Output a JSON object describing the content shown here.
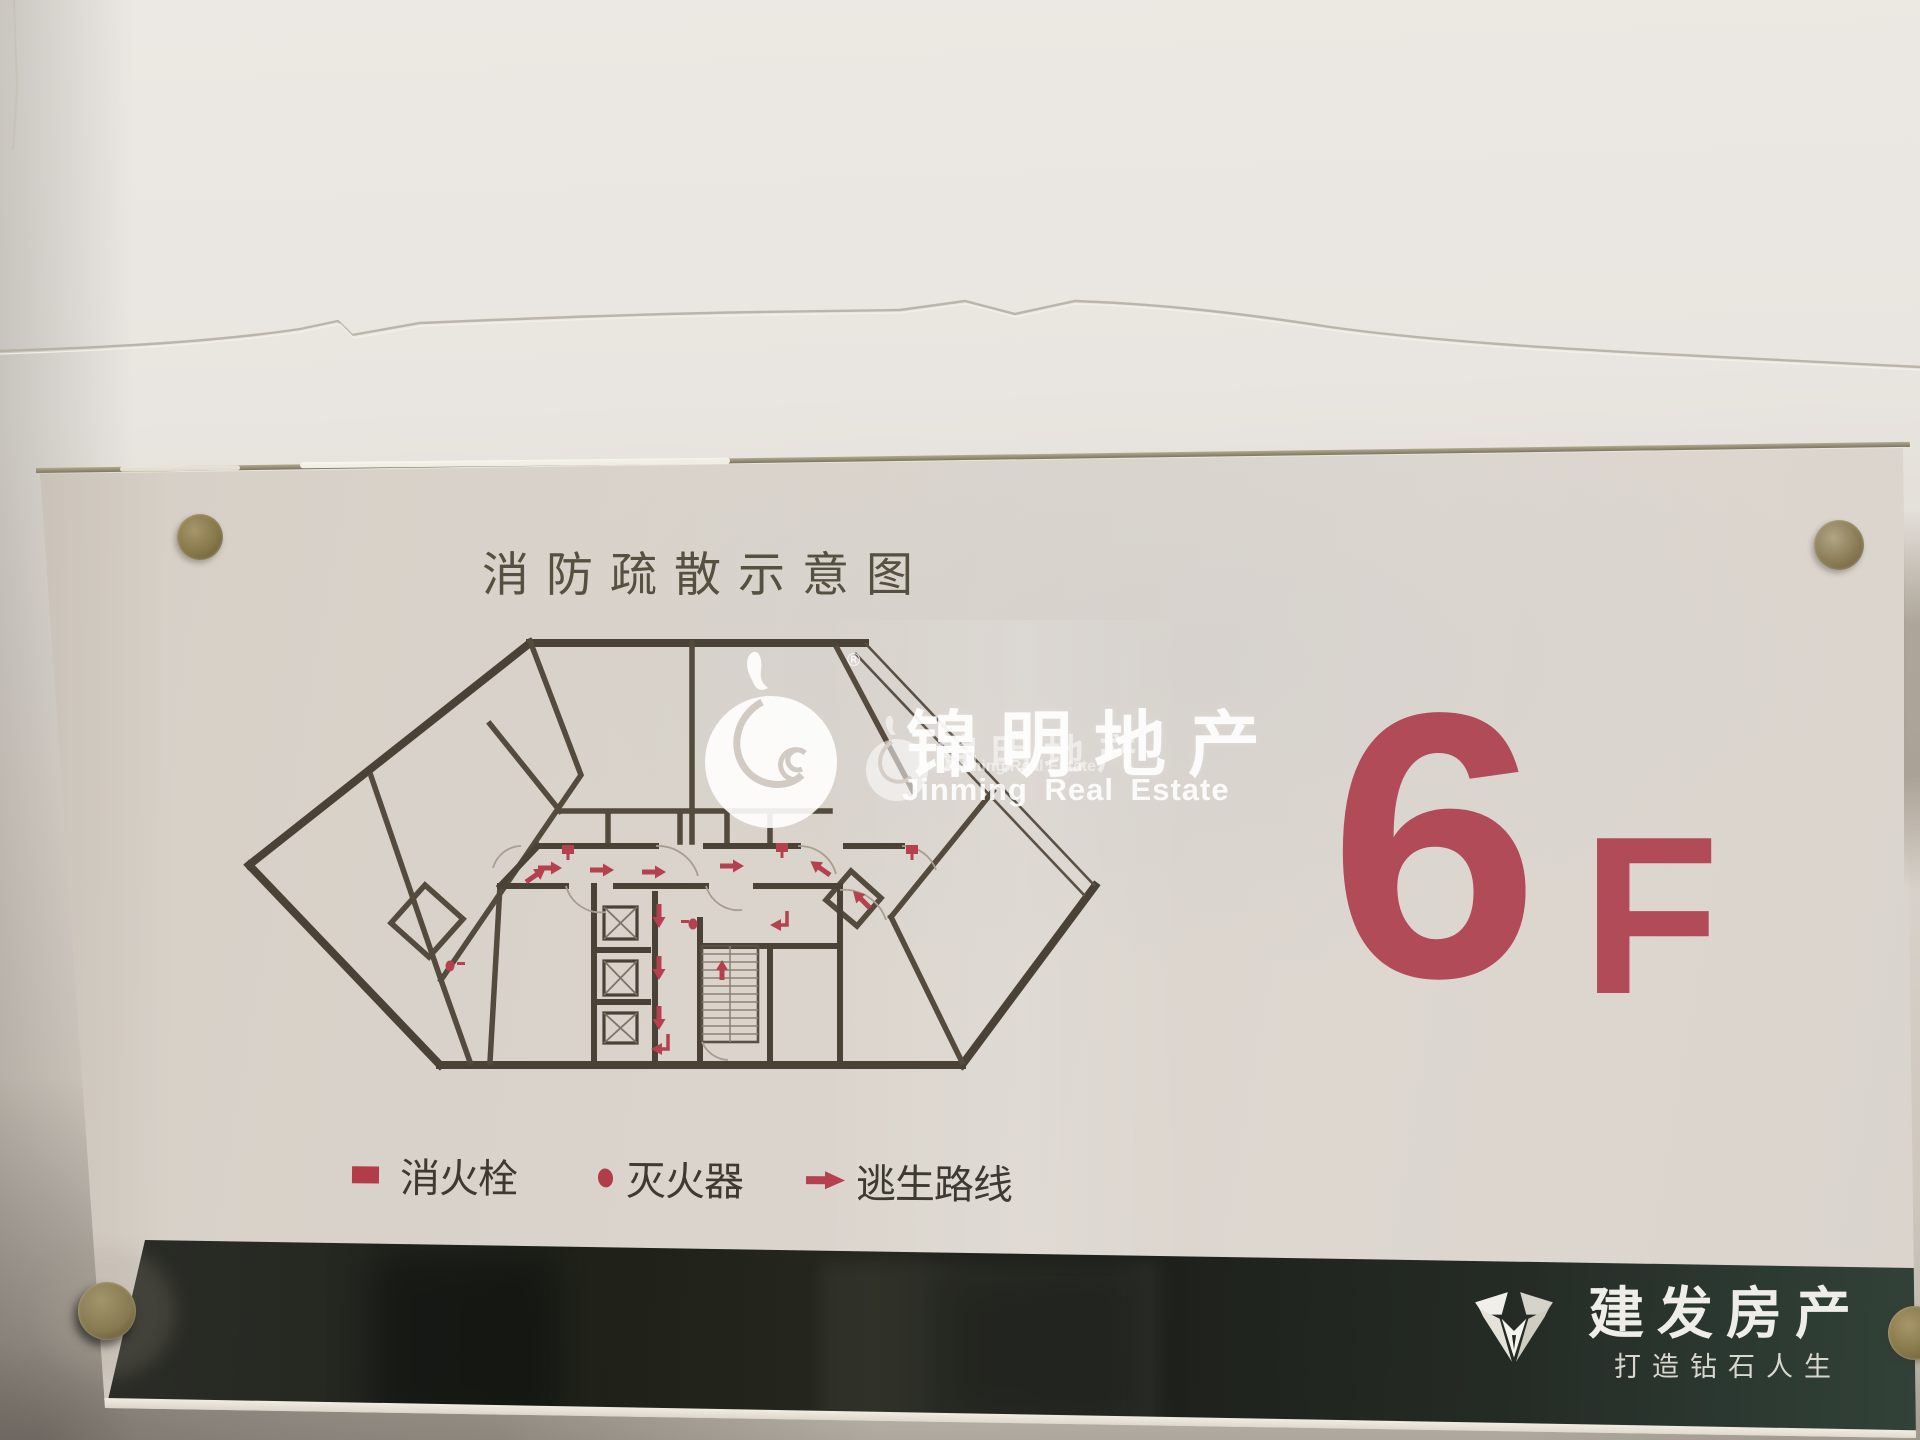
{
  "plate": {
    "title": "消防疏散示意图",
    "floor_label": {
      "number": "6",
      "suffix": "F"
    },
    "legend": {
      "items": [
        {
          "symbol": "hydrant-square",
          "label": "消火栓"
        },
        {
          "symbol": "extinguisher-dot",
          "label": "灭火器"
        },
        {
          "symbol": "route-arrow",
          "label": "逃生路线"
        }
      ]
    },
    "watermark": {
      "registered": "®",
      "cn": "锦明地产",
      "en": "Jinming Real Estate"
    },
    "brand": {
      "name": "建发房产",
      "slogan": "打造钻石人生"
    },
    "colors": {
      "legend_red": "#b23c48",
      "floor_red": "#b14b58",
      "plan_wall": "#4a4137",
      "band_background": "#23261f",
      "brass_screw": "#8d7f54"
    }
  }
}
